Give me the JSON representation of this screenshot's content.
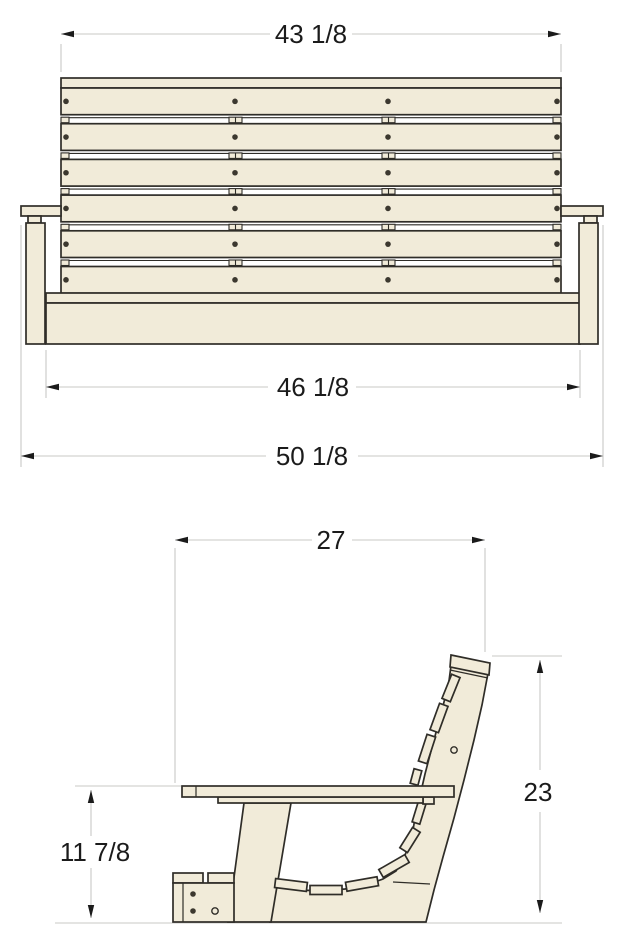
{
  "document": {
    "kind": "furniture-dimension-drawing",
    "subject": "porch swing bench, front and side elevations",
    "background": "#ffffff"
  },
  "colors": {
    "wood_fill": "#f1ebd9",
    "outline": "#2f2d28",
    "dimension_line": "#c8c8c6",
    "dimension_text": "#1b1b1b",
    "screw_dot": "#3c382f"
  },
  "views": {
    "front": {
      "name": "front-elevation",
      "back_slat_rows": 6,
      "screw_columns_per_row": 4,
      "dimensions": {
        "back_width": {
          "label": "43 1/8"
        },
        "seat_width": {
          "label": "46 1/8"
        },
        "overall_width": {
          "label": "50 1/8"
        }
      }
    },
    "side": {
      "name": "side-elevation",
      "seat_slat_sections": 6,
      "back_slat_sections": 4,
      "foot_screws": 2,
      "foot_holes": 1,
      "back_post_holes": 1,
      "dimensions": {
        "overall_depth": {
          "label": "27"
        },
        "back_height": {
          "label": "23"
        },
        "seat_height": {
          "label": "11 7/8"
        }
      }
    }
  }
}
